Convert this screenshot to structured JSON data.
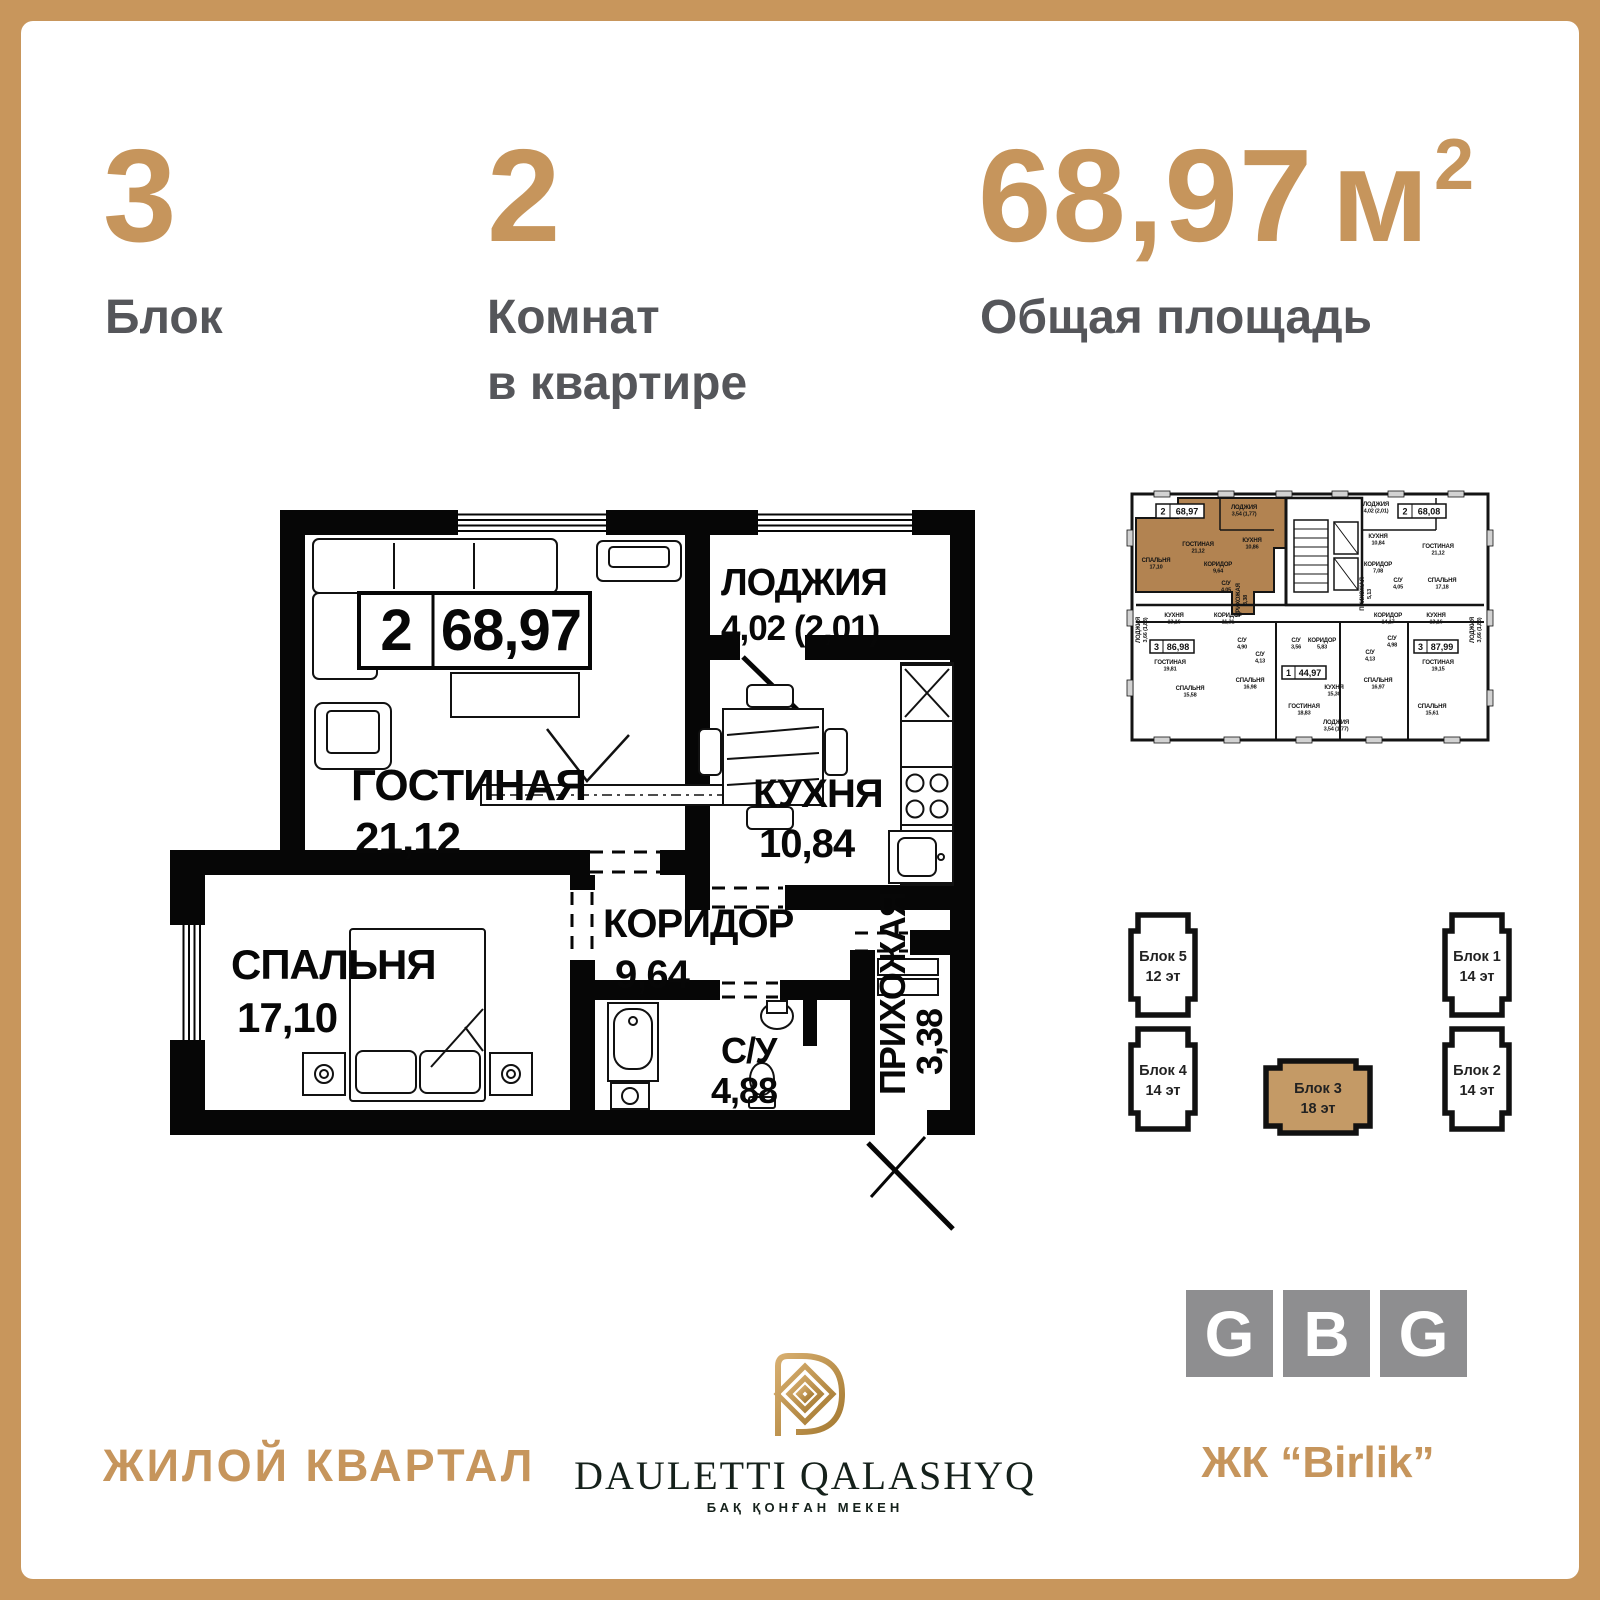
{
  "frame": {
    "accent": "#C8965C"
  },
  "header": {
    "block_value": "3",
    "block_label": "Блок",
    "rooms_value": "2",
    "rooms_label_1": "Комнат",
    "rooms_label_2": "в квартире",
    "area_value": "68,97",
    "area_unit": "м",
    "area_sup": "2",
    "area_label": "Общая площадь"
  },
  "plan": {
    "badge_rooms": "2",
    "badge_area": "68,97",
    "rooms": [
      {
        "name": "ГОСТИНАЯ",
        "area": "21,12"
      },
      {
        "name": "ЛОДЖИЯ",
        "area": "4,02 (2,01)"
      },
      {
        "name": "КУХНЯ",
        "area": "10,84"
      },
      {
        "name": "СПАЛЬНЯ",
        "area": "17,10"
      },
      {
        "name": "КОРИДОР",
        "area": "9,64"
      },
      {
        "name": "С/У",
        "area": "4,88"
      },
      {
        "name": "ПРИХОЖАЯ",
        "area": "3,38"
      }
    ]
  },
  "floorplate": {
    "plates": [
      {
        "rooms": "2",
        "area": "68,97"
      },
      {
        "rooms": "2",
        "area": "68,08"
      },
      {
        "rooms": "3",
        "area": "86,98"
      },
      {
        "rooms": "1",
        "area": "44,97"
      },
      {
        "rooms": "3",
        "area": "87,99"
      }
    ],
    "labels": [
      {
        "n": "ЛОДЖИЯ",
        "a": "3,54 (1,77)"
      },
      {
        "n": "ГОСТИНАЯ",
        "a": "21,12"
      },
      {
        "n": "КУХНЯ",
        "a": "10,86"
      },
      {
        "n": "СПАЛЬНЯ",
        "a": "17,10"
      },
      {
        "n": "КОРИДОР",
        "a": "9,64"
      },
      {
        "n": "С/У",
        "a": "4,05"
      },
      {
        "n": "ПРИХОЖАЯ",
        "a": "3,38"
      },
      {
        "n": "ЛОДЖИЯ",
        "a": "4,02 (2,01)"
      },
      {
        "n": "КУХНЯ",
        "a": "10,84"
      },
      {
        "n": "ГОСТИНАЯ",
        "a": "21,12"
      },
      {
        "n": "КОРИДОР",
        "a": "7,08"
      },
      {
        "n": "ПРИХОЖАЯ",
        "a": "5,13"
      },
      {
        "n": "С/У",
        "a": "4,05"
      },
      {
        "n": "СПАЛЬНЯ",
        "a": "17,18"
      },
      {
        "n": "ЛОДЖИЯ",
        "a": "3,66 (1,83)"
      },
      {
        "n": "КУХНЯ",
        "a": "13,16"
      },
      {
        "n": "КОРИДОР",
        "a": "11,31"
      },
      {
        "n": "ГОСТИНАЯ",
        "a": "19,81"
      },
      {
        "n": "СПАЛЬНЯ",
        "a": "15,58"
      },
      {
        "n": "С/У",
        "a": "4,90"
      },
      {
        "n": "С/У",
        "a": "4,13"
      },
      {
        "n": "СПАЛЬНЯ",
        "a": "16,98"
      },
      {
        "n": "С/У",
        "a": "3,56"
      },
      {
        "n": "КОРИДОР",
        "a": "5,83"
      },
      {
        "n": "КУХНЯ",
        "a": "15,30"
      },
      {
        "n": "ГОСТИНАЯ",
        "a": "18,83"
      },
      {
        "n": "ЛОДЖИЯ",
        "a": "3,54 (1,77)"
      },
      {
        "n": "С/У",
        "a": "4,13"
      },
      {
        "n": "С/У",
        "a": "4,98"
      },
      {
        "n": "КОРИДОР",
        "a": "14,17"
      },
      {
        "n": "КУХНЯ",
        "a": "13,16"
      },
      {
        "n": "ГОСТИНАЯ",
        "a": "19,15"
      },
      {
        "n": "СПАЛЬНЯ",
        "a": "16,97"
      },
      {
        "n": "СПАЛЬНЯ",
        "a": "15,61"
      },
      {
        "n": "ЛОДЖИЯ",
        "a": "3,66 (1,83)"
      }
    ]
  },
  "blocks": [
    {
      "name": "Блок 5",
      "floors": "12 эт"
    },
    {
      "name": "Блок 4",
      "floors": "14 эт"
    },
    {
      "name": "Блок 3",
      "floors": "18 эт"
    },
    {
      "name": "Блок 1",
      "floors": "14 эт"
    },
    {
      "name": "Блок 2",
      "floors": "14 эт"
    }
  ],
  "footer": {
    "district": "ЖИЛОЙ КВАРТАЛ",
    "developer_name": "DAULETTI QALASHYQ",
    "developer_tagline": "БАҚ ҚОНҒАН МЕКЕН",
    "gbg": [
      "G",
      "B",
      "G"
    ],
    "complex": "ЖК “Birlik”"
  }
}
